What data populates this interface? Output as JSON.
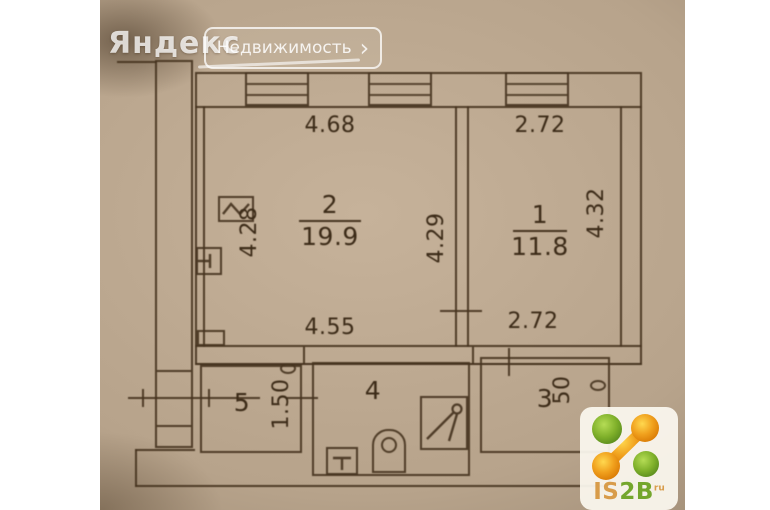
{
  "watermark": {
    "brand": "Яндекс",
    "product": "Недвижимость",
    "chevron": "›"
  },
  "logo": {
    "part1": "IS",
    "part2": "2B",
    "suffix": "ru"
  },
  "floorplan": {
    "room2": {
      "number": "2",
      "area": "19.9",
      "dim_top": "4.68",
      "dim_left": "4.28",
      "dim_right": "4.29",
      "dim_bottom": "4.55"
    },
    "room1": {
      "number": "1",
      "area": "11.8",
      "dim_top": "2.72",
      "dim_right": "4.32",
      "dim_bottom": "2.72"
    },
    "room5": {
      "number": "5",
      "dim_right": "1.50"
    },
    "room4": {
      "number": "4"
    },
    "room3": {
      "number": "3",
      "dim_right": "50"
    }
  },
  "colors": {
    "paper": "#b7a38b",
    "line": "#463420",
    "logo_green": "#74a62c",
    "logo_orange": "#e8920c",
    "watermark_white": "#ffffff"
  }
}
